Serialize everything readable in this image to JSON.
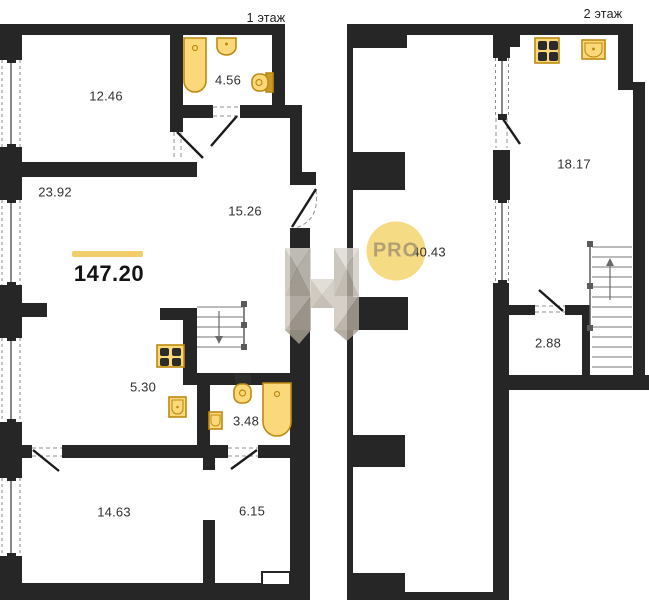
{
  "floor1": {
    "title": "1 этаж",
    "total_area": "147.20",
    "rooms": [
      {
        "name": "bedroom",
        "area": "12.46"
      },
      {
        "name": "bathroom",
        "area": "4.56"
      },
      {
        "name": "living-room",
        "area": "23.92"
      },
      {
        "name": "hallway",
        "area": "15.26"
      },
      {
        "name": "kitchen",
        "area": "5.30"
      },
      {
        "name": "bathroom-small",
        "area": "3.48"
      },
      {
        "name": "bedroom-2",
        "area": "14.63"
      },
      {
        "name": "hall-2",
        "area": "6.15"
      }
    ]
  },
  "floor2": {
    "title": "2 этаж",
    "rooms": [
      {
        "name": "kitchen-living",
        "area": "18.17"
      },
      {
        "name": "open-space",
        "area": "40.43"
      },
      {
        "name": "wc",
        "area": "2.88"
      }
    ]
  },
  "watermark": {
    "pro": "PRO"
  },
  "icons": [
    "bathtub-icon",
    "sink-icon",
    "toilet-icon",
    "stove-icon",
    "stairs-icon",
    "door-swing-icon",
    "window-icon"
  ],
  "colors": {
    "wall": "#262626",
    "fixture_fill": "#FBD97B",
    "fixture_stroke": "#BE8A10",
    "accent_bar": "#F2CE6B",
    "watermark_circle": "#F6D97E",
    "watermark_text": "#A49470"
  }
}
